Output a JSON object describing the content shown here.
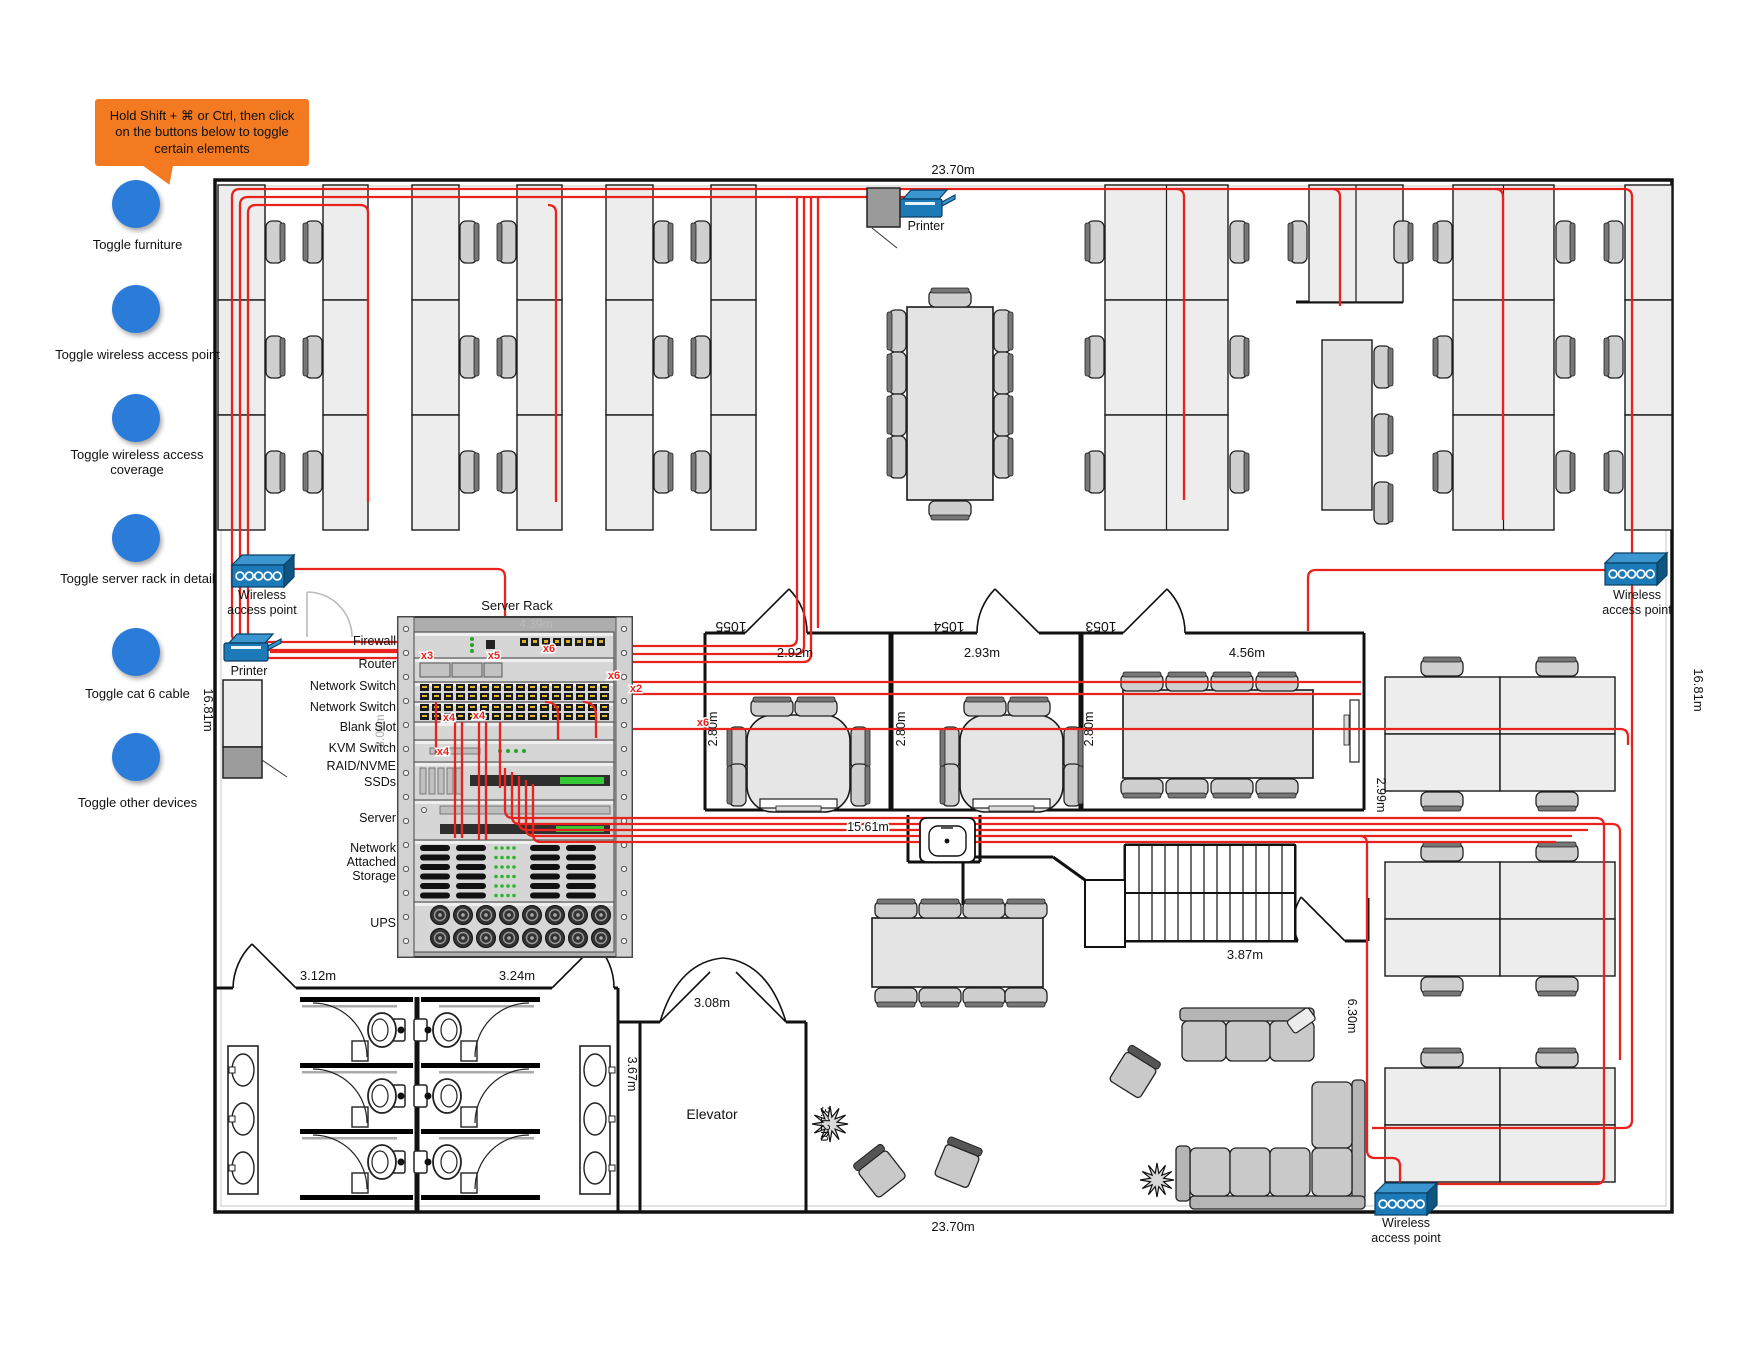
{
  "callout": {
    "text": "Hold Shift + ⌘ or Ctrl, then click on the buttons below to toggle certain elements"
  },
  "toggles": [
    {
      "label": "Toggle furniture"
    },
    {
      "label": "Toggle wireless access point"
    },
    {
      "label": "Toggle wireless access coverage"
    },
    {
      "label": "Toggle server rack in detail"
    },
    {
      "label": "Toggle cat 6 cable"
    },
    {
      "label": "Toggle other devices"
    }
  ],
  "dims": {
    "width_top": "23.70m",
    "width_bottom": "23.70m",
    "height_left": "16.81m",
    "height_right": "16.81m"
  },
  "rooms": [
    {
      "number": "1055",
      "width": "2.92m",
      "depth": "2.80m"
    },
    {
      "number": "1054",
      "width": "2.93m",
      "depth": "2.80m"
    },
    {
      "number": "1053",
      "width": "4.56m",
      "depth": "2.80m"
    }
  ],
  "measurements": {
    "hall": "15.61m",
    "restroom_left": "3.12m",
    "restroom_right": "3.24m",
    "elevator_width": "3.08m",
    "corridor": "3.67m",
    "elevator_side": "3.12m",
    "stairs": "3.87m",
    "lounge": "6.30m",
    "desk_gap": "2.99m",
    "rack_height": "3.06m",
    "rack_width": "4.39m"
  },
  "rack": {
    "title": "Server Rack",
    "slots": [
      {
        "label": "Firewall",
        "lines": [
          "Firewall"
        ]
      },
      {
        "label": "Router",
        "lines": [
          "Router"
        ]
      },
      {
        "label": "Network Switch",
        "lines": [
          "Network Switch"
        ]
      },
      {
        "label": "Network Switch",
        "lines": [
          "Network Switch"
        ]
      },
      {
        "label": "Blank Slot",
        "lines": [
          "Blank Slot"
        ]
      },
      {
        "label": "KVM Switch",
        "lines": [
          "KVM Switch"
        ]
      },
      {
        "label": "RAID/NVME SSDs",
        "lines": [
          "RAID/NVME",
          "SSDs"
        ]
      },
      {
        "label": "Server",
        "lines": [
          "Server"
        ]
      },
      {
        "label": "Network Attached Storage",
        "lines": [
          "Network",
          "Attached",
          "Storage"
        ]
      },
      {
        "label": "UPS",
        "lines": [
          "UPS"
        ]
      }
    ]
  },
  "labels": {
    "elevator": "Elevator",
    "printer": "Printer",
    "wireless_ap_line1": "Wireless",
    "wireless_ap_line2": "access point"
  },
  "cable_labels": [
    {
      "text": "x3"
    },
    {
      "text": "x5"
    },
    {
      "text": "x6"
    },
    {
      "text": "x6"
    },
    {
      "text": "x2"
    },
    {
      "text": "x6"
    },
    {
      "text": "x4"
    },
    {
      "text": "x4"
    },
    {
      "text": "x4"
    }
  ],
  "colors": {
    "cable": "#e8231d",
    "device_blue": "#1d7ab8",
    "button_blue": "#2a7cd8",
    "callout_orange": "#f37a20"
  }
}
